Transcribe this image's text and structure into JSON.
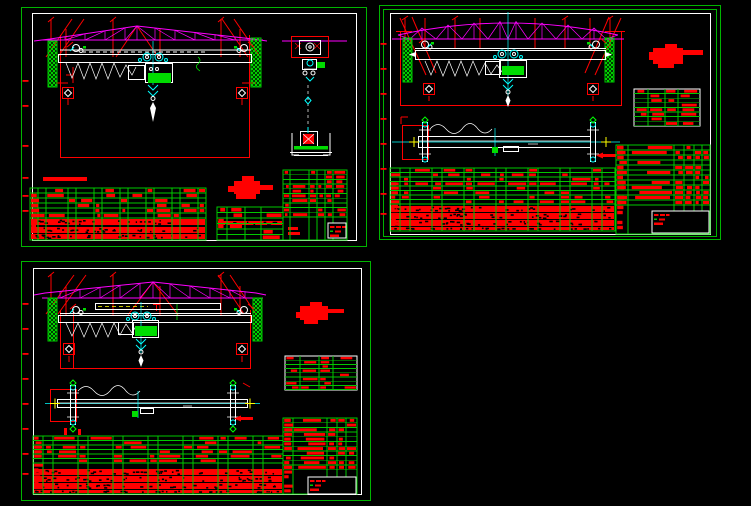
{
  "canvas": {
    "width": 751,
    "height": 506,
    "background": "#000000"
  },
  "colors": {
    "background": "#000000",
    "frame_green": "#00B400",
    "grid_green": "#00C800",
    "bright_green": "#00FF00",
    "motor_green": "#00DC00",
    "hatch_green": "#00E000",
    "red": "#FF0000",
    "magenta": "#FF00FF",
    "cyan": "#00FFFF",
    "white": "#FFFFFF",
    "yellow": "#FFFF00"
  },
  "sheets": [
    {
      "id": "sheet1",
      "name": "crane-elevation-with-end-view-sheet",
      "left": 20,
      "top": 5,
      "width": 348,
      "height": 243,
      "margin_ticks": [
        75,
        100,
        140,
        172,
        190,
        205
      ],
      "stamp": [
        [
          214,
          176,
          26,
          13
        ],
        [
          222,
          171,
          12,
          7
        ],
        [
          240,
          180,
          13,
          5
        ],
        [
          216,
          189,
          20,
          5
        ],
        [
          208,
          181,
          8,
          6
        ]
      ],
      "bars": [
        [
          23,
          172,
          44,
          4
        ],
        [
          268,
          222,
          10,
          3
        ],
        [
          268,
          227,
          12,
          3
        ]
      ],
      "tables": [
        {
          "x": 10,
          "y": 183,
          "w": 176,
          "h": 52,
          "border": "grid",
          "row_h": 5,
          "grid_h": 30,
          "vlines": [
            8,
            16,
            38,
            46,
            64,
            72,
            90,
            98,
            116,
            124,
            142,
            150,
            168
          ],
          "dense": [
            {
              "dy": 31,
              "h": 6
            },
            {
              "dy": 39,
              "h": 6
            },
            {
              "dy": 46,
              "h": 5
            }
          ],
          "left_band": true,
          "density": 0.45,
          "seed": 11
        },
        {
          "x": 197,
          "y": 202,
          "w": 66,
          "h": 33,
          "border": "grid",
          "row_h": 5.5,
          "grid_h": 33,
          "vlines": [
            10,
            28,
            44
          ],
          "dense": [
            {
              "dy": 14,
              "h": 4
            }
          ],
          "density": 0.5,
          "seed": 22
        },
        {
          "x": 263,
          "y": 165,
          "w": 64,
          "h": 70,
          "border": "grid",
          "row_h": 4.7,
          "grid_h": 51,
          "vlines": [
            7,
            26,
            34,
            42,
            50
          ],
          "white_box": {
            "dx": 45,
            "dy": 53,
            "w": 18,
            "h": 15
          },
          "density": 0.42,
          "seed": 33
        }
      ]
    },
    {
      "id": "sheet2",
      "name": "crane-elevation-with-girder-plan-sheet",
      "left": 378,
      "top": 3,
      "width": 345,
      "height": 238,
      "margin_ticks": [
        40,
        65,
        90,
        115,
        140,
        165,
        190,
        210
      ],
      "stamp": [
        [
          275,
          45,
          30,
          16
        ],
        [
          287,
          41,
          12,
          6
        ],
        [
          305,
          47,
          20,
          5
        ],
        [
          271,
          49,
          6,
          8
        ],
        [
          280,
          61,
          16,
          4
        ]
      ],
      "bars": [],
      "tables": [
        {
          "x": 12,
          "y": 165,
          "w": 225,
          "h": 63,
          "border": "grid",
          "row_h": 4.5,
          "grid_h": 36,
          "vlines": [
            10,
            20,
            42,
            52,
            74,
            84,
            106,
            116,
            138,
            148,
            170,
            180,
            202,
            212
          ],
          "dense": [
            {
              "dy": 38,
              "h": 6
            },
            {
              "dy": 45,
              "h": 6
            },
            {
              "dy": 52,
              "h": 6
            },
            {
              "dy": 59,
              "h": 3
            }
          ],
          "left_band": true,
          "density": 0.5,
          "seed": 44
        },
        {
          "x": 256,
          "y": 86,
          "w": 66,
          "h": 37,
          "border": "white",
          "row_h": 4.6,
          "grid_h": 37,
          "vlines": [
            14,
            31,
            44
          ],
          "density": 0.55,
          "seed": 55
        },
        {
          "x": 238,
          "y": 142,
          "w": 94,
          "h": 89,
          "border": "grid",
          "row_h": 5,
          "grid_h": 62,
          "vlines": [
            12,
            58,
            68,
            78,
            86
          ],
          "white_box": {
            "dx": 36,
            "dy": 66,
            "w": 57,
            "h": 22
          },
          "left_band": true,
          "density": 0.68,
          "seed": 66
        }
      ]
    },
    {
      "id": "sheet3",
      "name": "crane-elevation-with-girder-plan-sheet-2",
      "left": 20,
      "top": 258,
      "width": 352,
      "height": 246,
      "margin_ticks": [
        45,
        70,
        95,
        120,
        145,
        170,
        195,
        215
      ],
      "stamp": [
        [
          280,
          48,
          28,
          14
        ],
        [
          290,
          44,
          12,
          6
        ],
        [
          308,
          51,
          16,
          4
        ],
        [
          276,
          54,
          6,
          6
        ],
        [
          284,
          62,
          14,
          4
        ]
      ],
      "bars": [
        [
          44,
          170,
          3,
          7
        ],
        [
          58,
          171,
          3,
          6
        ]
      ],
      "tables": [
        {
          "x": 13,
          "y": 178,
          "w": 250,
          "h": 58,
          "border": "grid",
          "row_h": 4.5,
          "grid_h": 31,
          "vlines": [
            10,
            20,
            45,
            55,
            80,
            90,
            115,
            125,
            150,
            160,
            185,
            195,
            220,
            230
          ],
          "dense": [
            {
              "dy": 33,
              "h": 6
            },
            {
              "dy": 40,
              "h": 6
            },
            {
              "dy": 47,
              "h": 6
            },
            {
              "dy": 54,
              "h": 3
            }
          ],
          "left_band": true,
          "density": 0.5,
          "seed": 77
        },
        {
          "x": 265,
          "y": 98,
          "w": 72,
          "h": 34,
          "border": "white",
          "row_h": 4.2,
          "grid_h": 34,
          "vlines": [
            15,
            34,
            48
          ],
          "density": 0.55,
          "seed": 88
        },
        {
          "x": 263,
          "y": 160,
          "w": 74,
          "h": 76,
          "border": "grid",
          "row_h": 4.7,
          "grid_h": 56,
          "vlines": [
            10,
            44,
            54,
            63
          ],
          "white_box": {
            "dx": 25,
            "dy": 59,
            "w": 48,
            "h": 17
          },
          "left_band": true,
          "density": 0.62,
          "seed": 99
        }
      ]
    }
  ]
}
